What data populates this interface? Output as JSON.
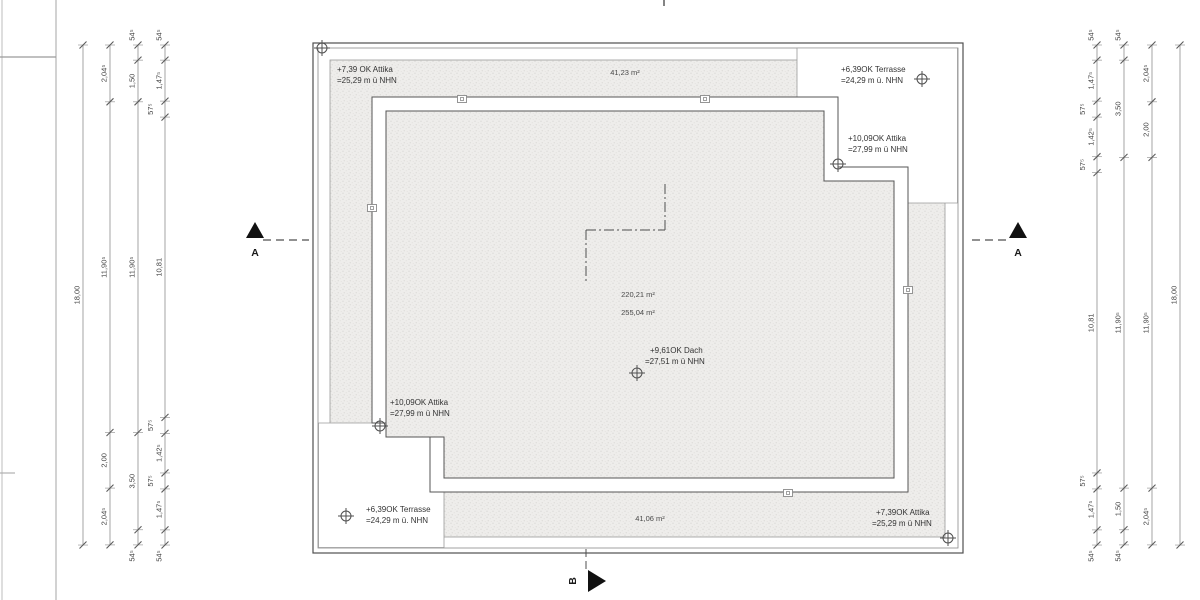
{
  "plan": {
    "elevation_labels": {
      "attika_top_left": {
        "l1": "+7,39 OK Attika",
        "l2": "=25,29 m ü NHN"
      },
      "terrasse_top_right": {
        "l1": "+6,39OK Terrasse",
        "l2": "=24,29 m ü. NHN"
      },
      "attika_top_right": {
        "l1": "+10,09OK Attika",
        "l2": "=27,99 m ü NHN"
      },
      "dach_center": {
        "l1": "+9,61OK Dach",
        "l2": "=27,51 m ü NHN"
      },
      "attika_bottom_left": {
        "l1": "+10,09OK Attika",
        "l2": "=27,99 m ü NHN"
      },
      "terrasse_bottom_left": {
        "l1": "+6,39OK Terrasse",
        "l2": "=24,29 m ü. NHN"
      },
      "attika_bottom_right": {
        "l1": "+7,39OK Attika",
        "l2": "=25,29 m ü NHN"
      }
    },
    "area_labels": {
      "top": "41,23 m²",
      "center_upper": "220,21 m²",
      "center_lower": "255,04 m²",
      "bottom": "41,06 m²"
    },
    "section_markers": {
      "a_left": "A",
      "a_right": "A",
      "b_bottom": "B"
    }
  },
  "dimensions": {
    "origin_y_px": 45,
    "px_per_m": 27.78,
    "left_chains": [
      {
        "x": 83,
        "segments": [
          {
            "label": "18,00",
            "m": 18.0
          }
        ]
      },
      {
        "x": 110,
        "segments": [
          {
            "label": "2,04⁵",
            "m": 2.045
          },
          {
            "label": "11,90⁵",
            "m": 11.905
          },
          {
            "label": "2,00",
            "m": 2.0
          },
          {
            "label": "2,04⁵",
            "m": 2.045
          }
        ]
      },
      {
        "x": 138,
        "segments": [
          {
            "label": "54⁵",
            "m": 0.545
          },
          {
            "label": "1,50",
            "m": 1.5
          },
          {
            "label": "11,90⁵",
            "m": 11.905
          },
          {
            "label": "3,50",
            "m": 3.5
          },
          {
            "label": "54⁵",
            "m": 0.545
          }
        ]
      },
      {
        "x": 165,
        "segments": [
          {
            "label": "54⁵",
            "m": 0.545
          },
          {
            "label": "1,47⁵",
            "m": 1.475
          },
          {
            "label": "57⁵",
            "m": 0.575
          },
          {
            "label": "10,81",
            "m": 10.81
          },
          {
            "label": "57⁵",
            "m": 0.575
          },
          {
            "label": "1,42⁵",
            "m": 1.425
          },
          {
            "label": "57⁵",
            "m": 0.575
          },
          {
            "label": "1,47⁵",
            "m": 1.475
          },
          {
            "label": "54⁵",
            "m": 0.545
          }
        ]
      }
    ],
    "right_chains": [
      {
        "x": 1097,
        "segments": [
          {
            "label": "54⁵",
            "m": 0.545
          },
          {
            "label": "1,47⁵",
            "m": 1.475
          },
          {
            "label": "57⁵",
            "m": 0.575
          },
          {
            "label": "1,42⁵",
            "m": 1.425
          },
          {
            "label": "57⁵",
            "m": 0.575
          },
          {
            "label": "10,81",
            "m": 10.81
          },
          {
            "label": "57⁵",
            "m": 0.575
          },
          {
            "label": "1,47⁵",
            "m": 1.475
          },
          {
            "label": "54⁵",
            "m": 0.545
          }
        ]
      },
      {
        "x": 1124,
        "segments": [
          {
            "label": "54⁵",
            "m": 0.545
          },
          {
            "label": "3,50",
            "m": 3.5
          },
          {
            "label": "11,90⁵",
            "m": 11.905
          },
          {
            "label": "1,50",
            "m": 1.5
          },
          {
            "label": "54⁵",
            "m": 0.545
          }
        ]
      },
      {
        "x": 1152,
        "segments": [
          {
            "label": "2,04⁵",
            "m": 2.045
          },
          {
            "label": "2,00",
            "m": 2.0
          },
          {
            "label": "11,90⁵",
            "m": 11.905
          },
          {
            "label": "2,04⁵",
            "m": 2.045
          }
        ]
      },
      {
        "x": 1180,
        "segments": [
          {
            "label": "18,00",
            "m": 18.0
          }
        ]
      }
    ]
  },
  "colors": {
    "line_dark": "#4f4f4f",
    "line_mid": "#8a8a8a",
    "dim_line": "#9a9a9a",
    "dim_text": "#444444",
    "anno_text": "#333333",
    "hatch_bg": "#eeedeb",
    "hatch_dot": "#d6d4d1",
    "marker_black": "#111111"
  }
}
